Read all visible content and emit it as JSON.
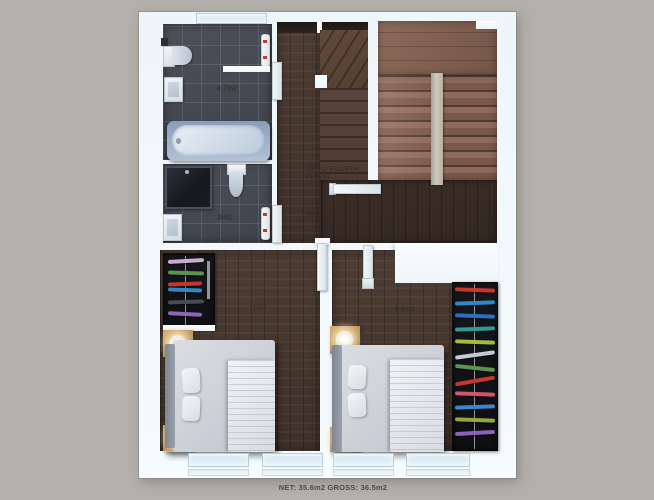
{
  "palette": {
    "background": "#b3afac",
    "plan_white": "#f4fafd",
    "wood_dark": "#46382f",
    "stair_wood": "#8a695b",
    "tile_dark": "#45494f"
  },
  "rooms": {
    "bath_upper": {
      "label": "4.7m2"
    },
    "bath_lower": {
      "label": "3m2"
    },
    "hall": {
      "label": "7.3m2"
    },
    "bedroom_left": {
      "label": "11m2"
    },
    "bedroom_right": {
      "label": "9.6m2"
    }
  },
  "stairs": {
    "note_line1": "UP TO FOURTH",
    "note_line2": "FLOOR"
  },
  "footer": {
    "area_summary": "NET: 35.6m2 GROSS: 36.5m2"
  }
}
